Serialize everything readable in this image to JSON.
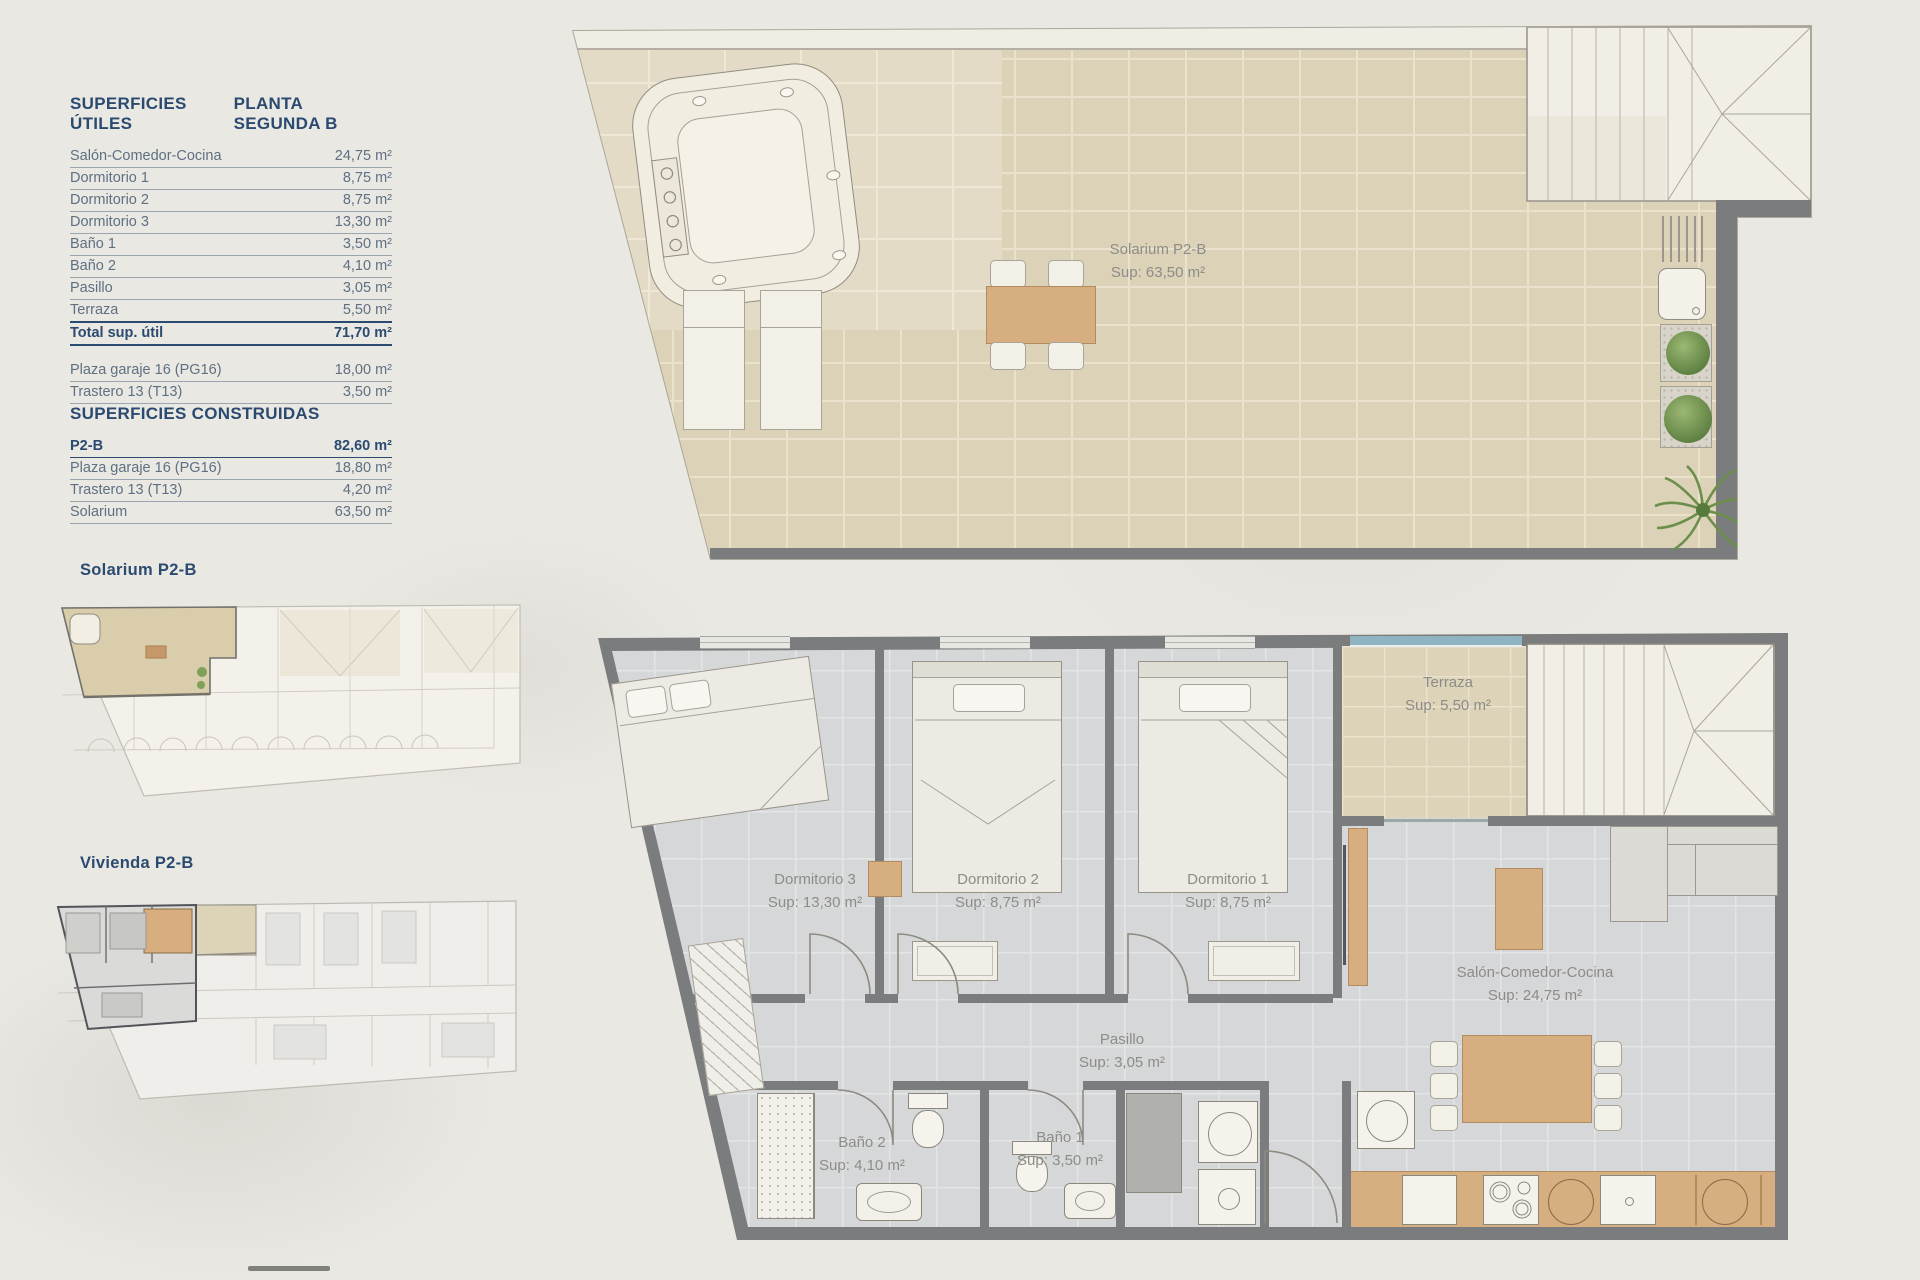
{
  "colors": {
    "accent": "#2b4a70",
    "table_text": "#5e7082",
    "rule": "#9aa5b0",
    "label_gray": "#8c8c88",
    "tile_beige": "#dcd2b7",
    "floor_gray": "#d6d7d8",
    "wall_gray": "#7b7c7d",
    "wood": "#d7ae7f",
    "plant_green": "#7fa05a",
    "glass_blue": "#8fb3c0"
  },
  "left_panel": {
    "utiles": {
      "title": "SUPERFICIES ÚTILES",
      "planta": "PLANTA SEGUNDA B",
      "rows": [
        {
          "label": "Salón-Comedor-Cocina",
          "value": "24,75 m²"
        },
        {
          "label": "Dormitorio 1",
          "value": "8,75 m²"
        },
        {
          "label": "Dormitorio 2",
          "value": "8,75 m²"
        },
        {
          "label": "Dormitorio 3",
          "value": "13,30 m²"
        },
        {
          "label": "Baño 1",
          "value": "3,50 m²"
        },
        {
          "label": "Baño 2",
          "value": "4,10 m²"
        },
        {
          "label": "Pasillo",
          "value": "3,05 m²"
        },
        {
          "label": "Terraza",
          "value": "5,50 m²"
        }
      ],
      "total": {
        "label": "Total sup. útil",
        "value": "71,70 m²"
      },
      "annex_rows": [
        {
          "label": "Plaza garaje 16 (PG16)",
          "value": "18,00 m²"
        },
        {
          "label": "Trastero 13 (T13)",
          "value": "3,50 m²"
        }
      ]
    },
    "construidas": {
      "title": "SUPERFICIES CONSTRUIDAS",
      "rows": [
        {
          "label": "P2-B",
          "value": "82,60 m²"
        },
        {
          "label": "Plaza garaje 16 (PG16)",
          "value": "18,80 m²"
        },
        {
          "label": "Trastero 13 (T13)",
          "value": "4,20 m²"
        },
        {
          "label": "Solarium",
          "value": "63,50 m²"
        }
      ]
    },
    "mini_solarium_label": "Solarium P2-B",
    "mini_vivienda_label": "Vivienda P2-B"
  },
  "solarium_plan": {
    "name": "Solarium P2-B",
    "area": "Sup: 63,50 m²"
  },
  "apartment_plan": {
    "dormitorio3": {
      "name": "Dormitorio 3",
      "area": "Sup: 13,30 m²"
    },
    "dormitorio2": {
      "name": "Dormitorio 2",
      "area": "Sup: 8,75 m²"
    },
    "dormitorio1": {
      "name": "Dormitorio 1",
      "area": "Sup: 8,75 m²"
    },
    "terraza": {
      "name": "Terraza",
      "area": "Sup: 5,50 m²"
    },
    "pasillo": {
      "name": "Pasillo",
      "area": "Sup: 3,05 m²"
    },
    "bano2": {
      "name": "Baño 2",
      "area": "Sup: 4,10 m²"
    },
    "bano1": {
      "name": "Baño 1",
      "area": "Sup: 3,50 m²"
    },
    "salon": {
      "name": "Salón-Comedor-Cocina",
      "area": "Sup: 24,75 m²"
    }
  }
}
